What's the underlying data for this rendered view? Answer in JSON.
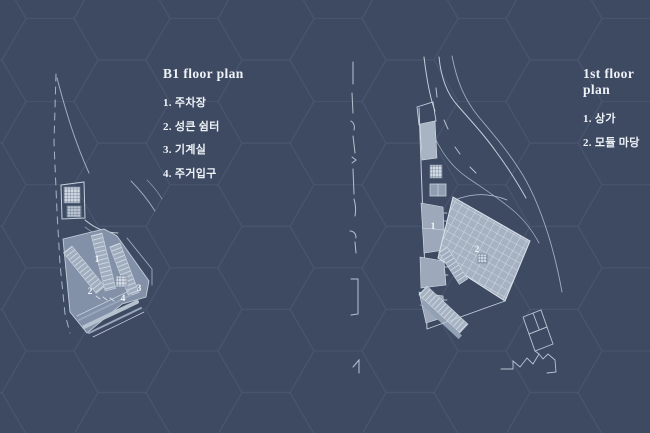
{
  "page": {
    "background_color": "#3d4a62",
    "hex_line_color": "#4f5e78",
    "text_color": "#eef2f7",
    "drawing_line_color": "#c3cedb",
    "plan_fill_color": "#8291a8",
    "courtyard_fill_color": "#a6b2c2"
  },
  "left_panel": {
    "title": "B1 floor plan",
    "items": [
      "1. 주차장",
      "2. 성큰 쉼터",
      "3. 기계실",
      "4. 주거입구"
    ]
  },
  "right_panel": {
    "title": "1st floor plan",
    "items": [
      "1. 상가",
      "2. 모듈 마당"
    ]
  },
  "b1_plan": {
    "labels": [
      "1",
      "2",
      "3",
      "4"
    ]
  },
  "f1_plan": {
    "labels": [
      "1",
      "2"
    ]
  }
}
